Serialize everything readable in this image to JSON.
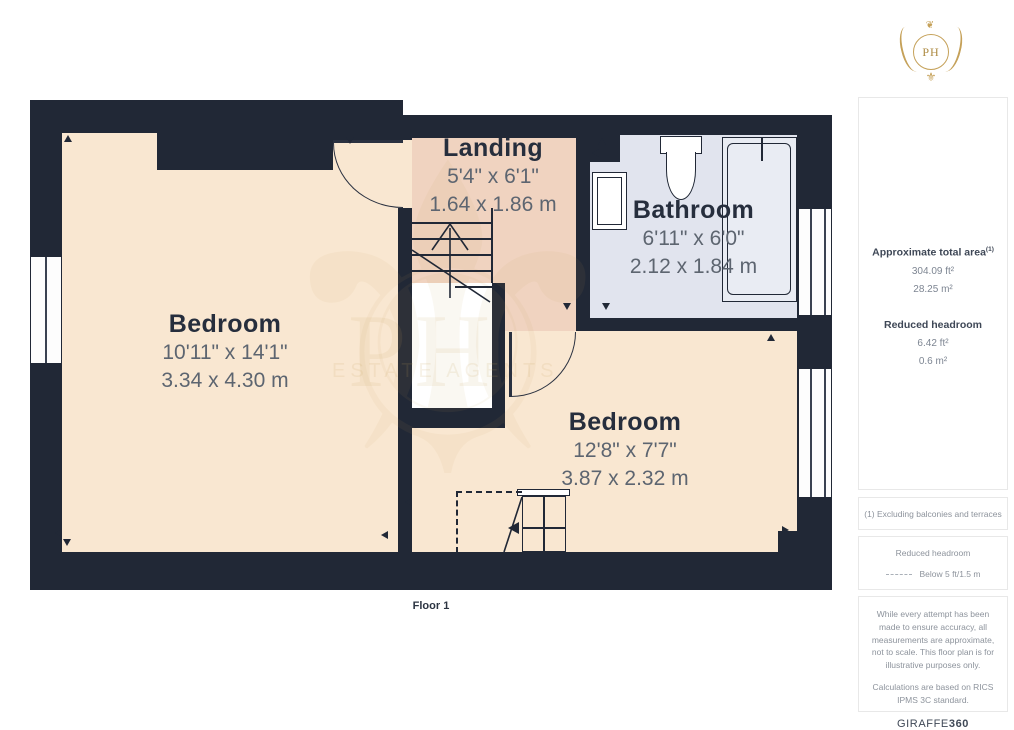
{
  "logo": {
    "monogram": "PH",
    "fleur_glyph": "⚜",
    "top_glyph": "❦"
  },
  "watermark": {
    "monogram": "PH",
    "text": "ESTATE AGENTS",
    "fleur_glyph": "⚜"
  },
  "floor_label": "Floor 1",
  "rooms": [
    {
      "name": "Bedroom",
      "dims_imperial": "10'11\" x 14'1\"",
      "dims_metric": "3.34 x 4.30 m"
    },
    {
      "name": "Landing",
      "dims_imperial": "5'4\" x 6'1\"",
      "dims_metric": "1.64 x 1.86 m"
    },
    {
      "name": "Bathroom",
      "dims_imperial": "6'11\" x 6'0\"",
      "dims_metric": "2.12 x 1.84 m"
    },
    {
      "name": "Bedroom",
      "dims_imperial": "12'8\" x 7'7\"",
      "dims_metric": "3.87 x 2.32 m"
    }
  ],
  "sidebar": {
    "area_section": {
      "title": "Approximate total area",
      "title_sup": "(1)",
      "area_ft": "304.09 ft²",
      "area_m": "28.25 m²",
      "reduced_title": "Reduced headroom",
      "reduced_ft": "6.42 ft²",
      "reduced_m": "0.6 m²"
    },
    "footnote": "(1) Excluding balconies and terraces",
    "legend": {
      "title": "Reduced headroom",
      "label": "Below 5 ft/1.5 m"
    },
    "disclaimer_1": "While every attempt has been made to ensure accuracy, all measurements are approximate, not to scale. This floor plan is for illustrative purposes only.",
    "disclaimer_2": "Calculations are based on RICS IPMS 3C standard.",
    "brand": {
      "name": "GIRAFFE",
      "suffix": "360"
    }
  },
  "colors": {
    "wall": "#212836",
    "bedroom_fill": "#f9e7d1",
    "landing_fill": "#f0d3c0",
    "bathroom_fill": "#e1e4ee",
    "brand_gold": "#c5a159"
  }
}
